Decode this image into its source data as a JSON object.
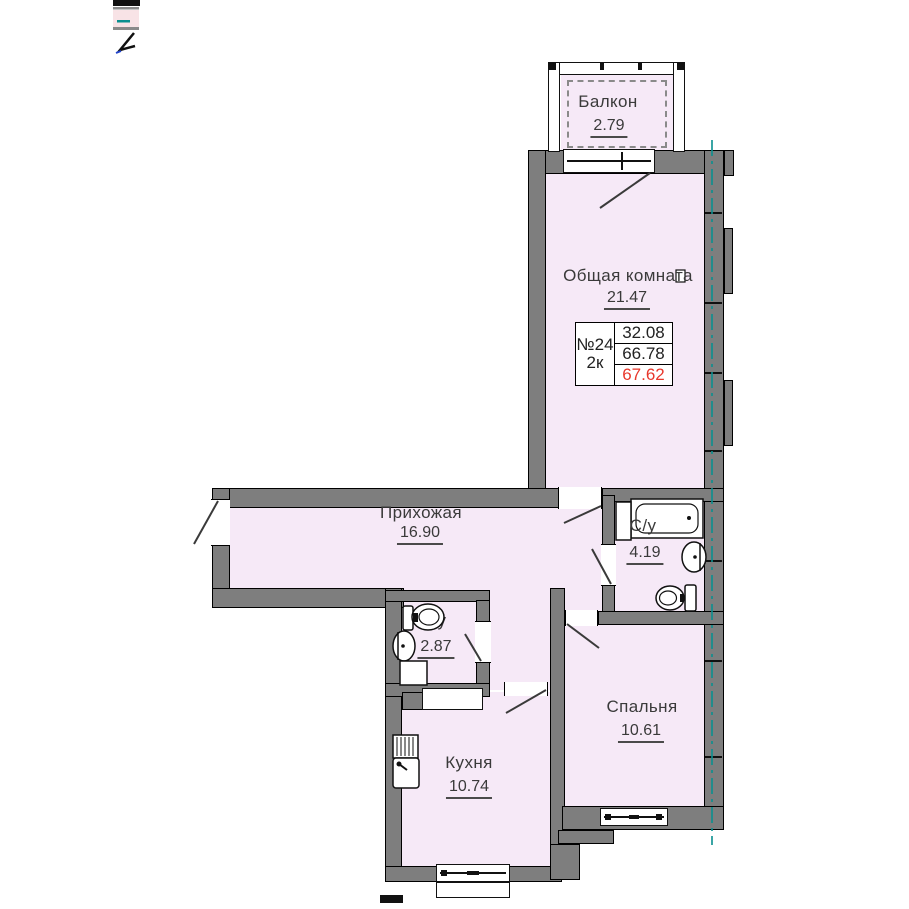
{
  "rooms": [
    {
      "id": "balcony",
      "name": "Балкон",
      "area": "2.79"
    },
    {
      "id": "living_room",
      "name": "Общая комната",
      "area": "21.47"
    },
    {
      "id": "hallway",
      "name": "Прихожая",
      "area": "16.90"
    },
    {
      "id": "bathroom",
      "name": "С/у",
      "area": "4.19"
    },
    {
      "id": "wc",
      "name": "С/у",
      "area": "2.87"
    },
    {
      "id": "kitchen",
      "name": "Кухня",
      "area": "10.74"
    },
    {
      "id": "bedroom",
      "name": "Спальня",
      "area": "10.61"
    }
  ],
  "info_table": {
    "apartment_number": "№24",
    "rooms_count": "2к",
    "living_area": "32.08",
    "area": "66.78",
    "total_area": "67.62"
  },
  "colors": {
    "room_fill": "#f6e9f7",
    "wall_fill": "#7e7e7e",
    "axis_teal": "#0a8f8f",
    "total_area_red": "#e8372b"
  }
}
